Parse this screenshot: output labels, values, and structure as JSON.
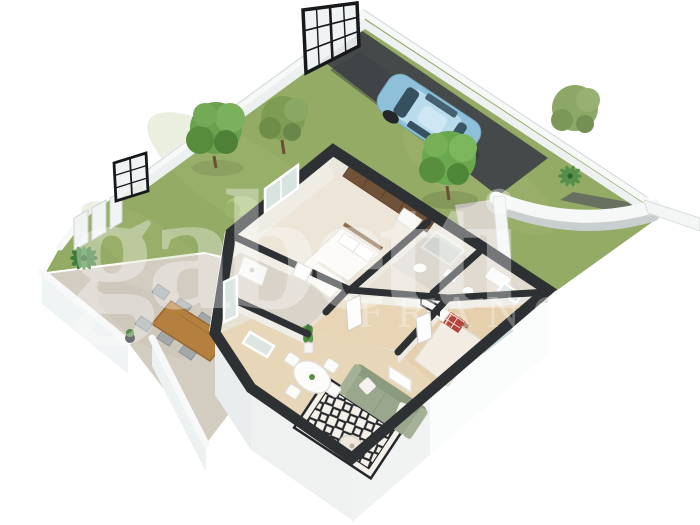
{
  "watermark": {
    "brand_text": "gabetti",
    "secondary_text": "FRANCHISING",
    "color": "#ffffff"
  },
  "scene": {
    "description": "3D cut-away floor plan of a single-storey home with walled garden, driveway, parked car and furnished terrace",
    "rooms": [
      "master bedroom",
      "shower room",
      "bathroom",
      "second bedroom",
      "hallway",
      "kitchen-dining room",
      "living room"
    ],
    "exterior_features": [
      "lawn",
      "terrace with dining set",
      "driveway",
      "parked car",
      "trees",
      "palm shrubs",
      "white boundary walls",
      "black grid gates",
      "curved feature wall"
    ]
  },
  "palette": {
    "lawn": "#93ab64",
    "lawn_light": "#a9bc7c",
    "driveway": "#46494a",
    "cut_wall": "#2e3133",
    "boundary_wall": "#f7f8f8",
    "terrace": "#d3ccc1",
    "wood_floor": "#e7d6b8",
    "sofa": "#9aa78c",
    "car_body": "#8ec1d9",
    "pillow_accent": "#b2443a",
    "wardrobe_wood": "#6f5237"
  }
}
